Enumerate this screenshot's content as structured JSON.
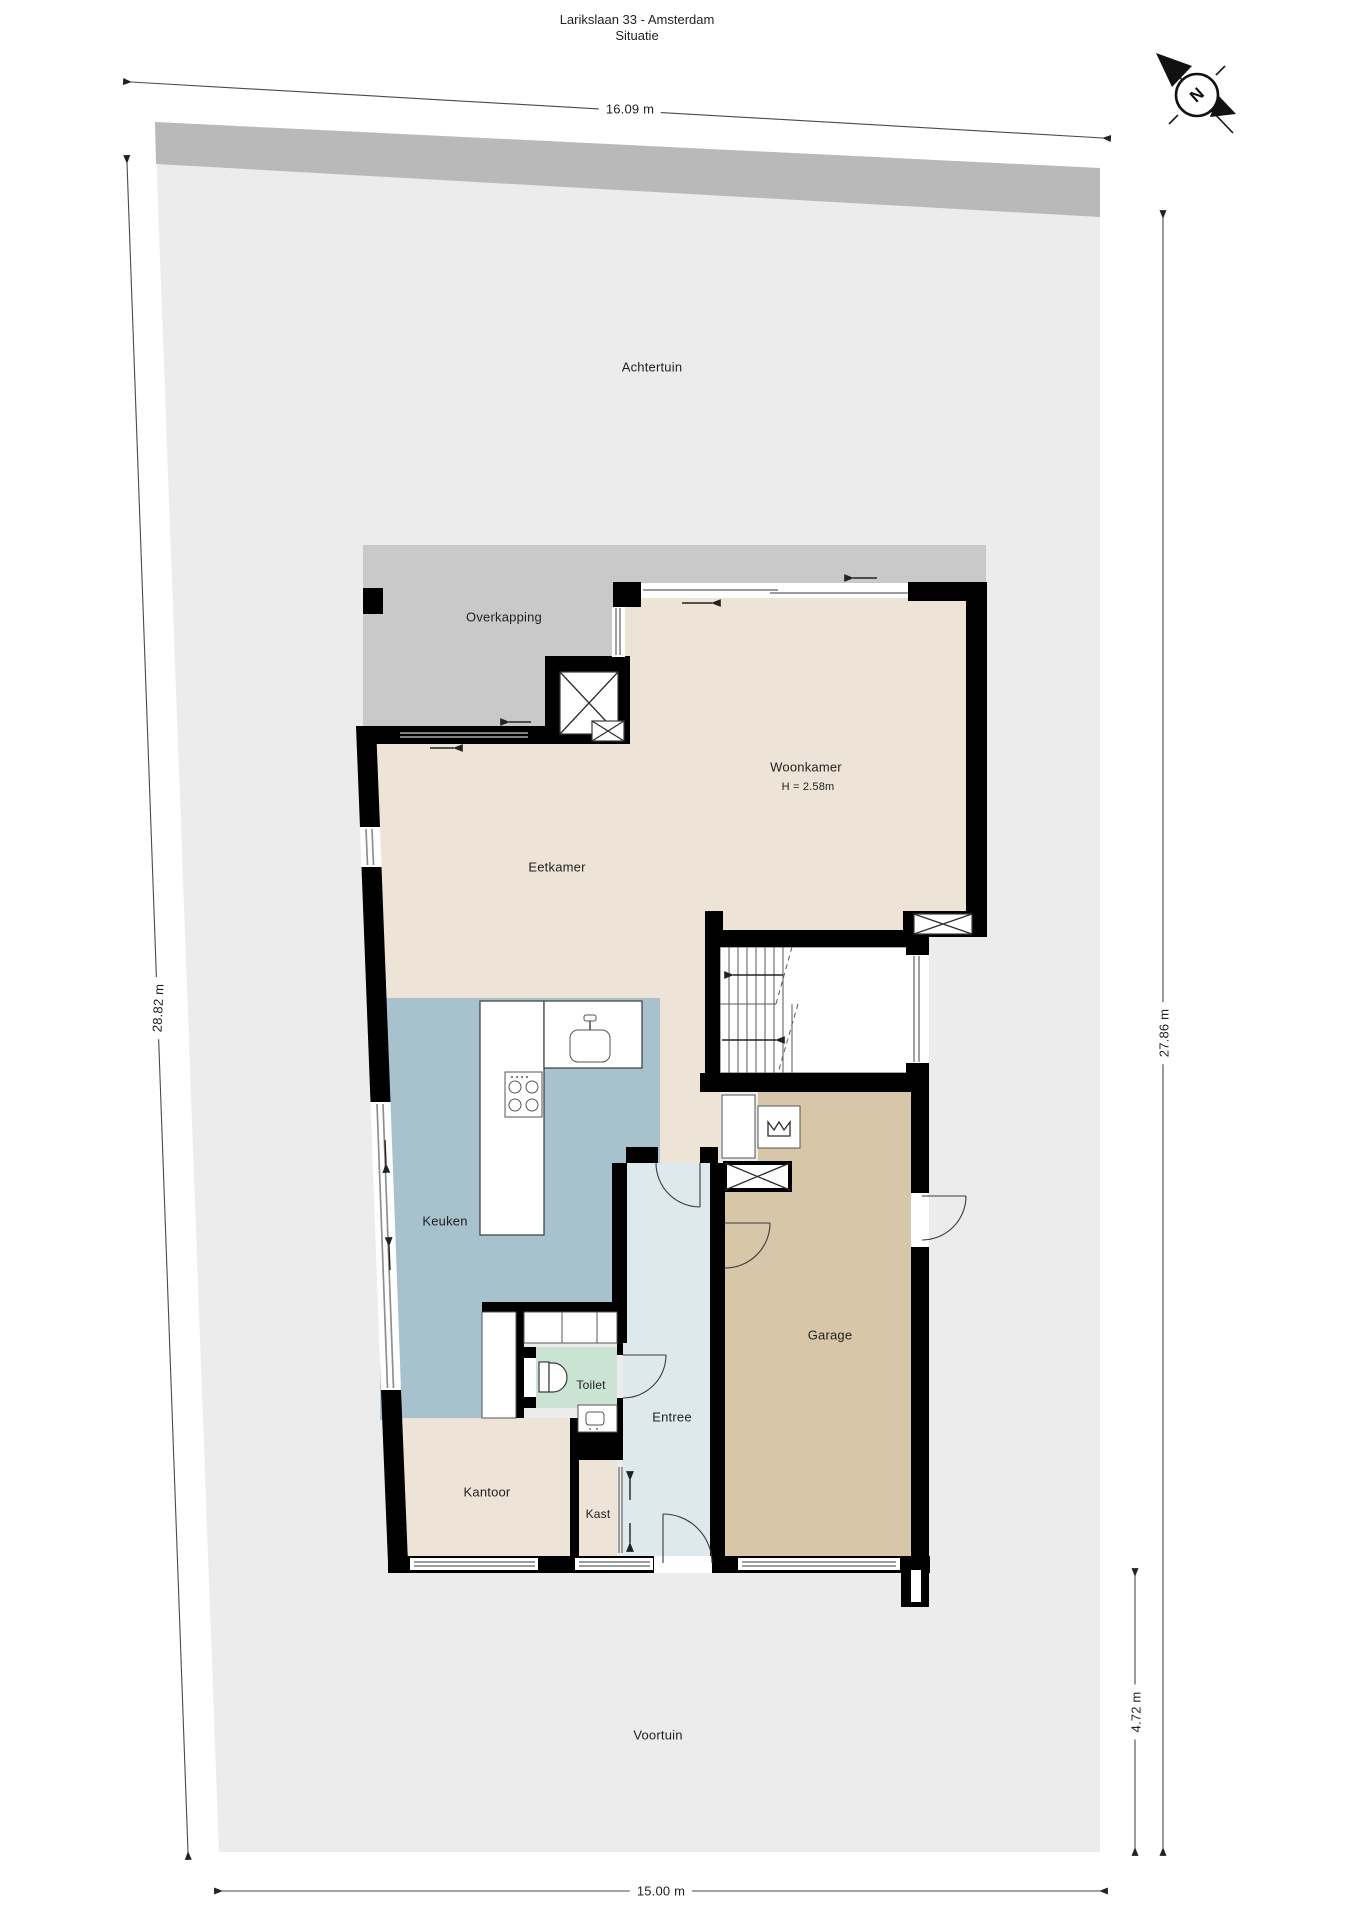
{
  "title": {
    "line1": "Larikslaan 33 - Amsterdam",
    "line2": "Situatie"
  },
  "compass": {
    "n": "N"
  },
  "garden": {
    "achtertuin": "Achtertuin",
    "voortuin": "Voortuin"
  },
  "rooms": {
    "overkapping": "Overkapping",
    "woonkamer": "Woonkamer",
    "woonkamer_height": "H = 2.58m",
    "eetkamer": "Eetkamer",
    "keuken": "Keuken",
    "toilet": "Toilet",
    "entree": "Entree",
    "kantoor": "Kantoor",
    "kast": "Kast",
    "garage": "Garage"
  },
  "dimensions": {
    "top": "16.09 m",
    "left": "28.82 m",
    "right": "27.86 m",
    "front_depth": "4.72 m",
    "bottom": "15.00 m"
  },
  "colors": {
    "plot": "#ececec",
    "hedge": "#b9b9b9",
    "overkapping": "#c9c9c9",
    "floor": "#ede3d7",
    "kitchen": "#a7c2cc",
    "entry": "#dde9ed",
    "toilet": "#cbe3d3",
    "garage": "#d7c7a8",
    "wall": "#000000",
    "window": "#8f8f8f",
    "text": "#1f1f1f"
  }
}
